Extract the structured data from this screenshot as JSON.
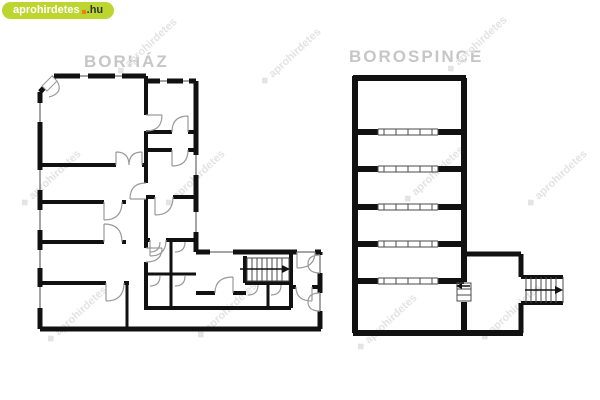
{
  "logo": {
    "brand": "aprohirdetes",
    "tld": ".hu"
  },
  "watermark": {
    "glyph": "❖",
    "text": "aprohirdetes"
  },
  "plans": {
    "borhaz": {
      "title": "BORHÁZ"
    },
    "borospince": {
      "title": "BOROSPINCE"
    }
  },
  "colors": {
    "background": "#ffffff",
    "wall": "#111111",
    "thin_line": "#4a4a4a",
    "door_arc": "#9a9a9a",
    "title_text": "#c6c6c6",
    "watermark_text": "#e3e3e3",
    "logo_green": "#bdd62f",
    "logo_orange": "#f07f13",
    "logo_dark": "#2d3138",
    "logo_text": "#ffffff"
  }
}
